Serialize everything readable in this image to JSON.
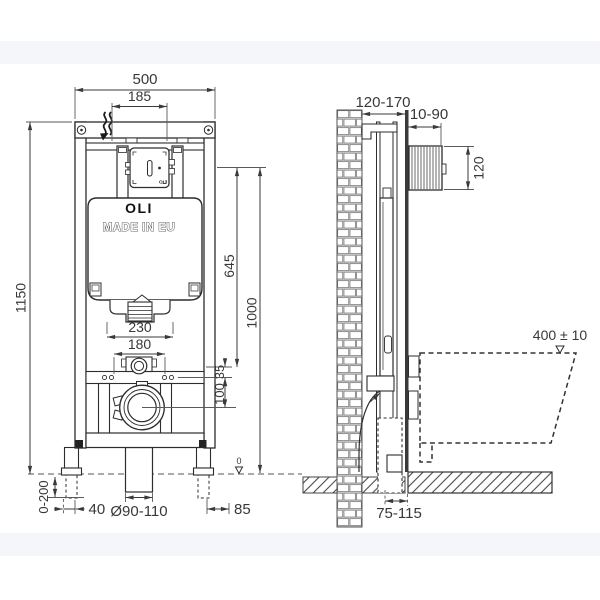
{
  "palette": {
    "line": "#2d2d2d",
    "dim_text": "#383838",
    "band": "#f4f6fa"
  },
  "front_view": {
    "dims": {
      "total_width": "500",
      "flush_plate_width": "185",
      "total_height": "1150",
      "flush_plate_height": "645",
      "reference_height": "1000",
      "bracket_width": "230",
      "fixing_spacing": "180",
      "inlet_offset": "35",
      "outlet_offset": "100",
      "foot_adjustment": "0-200",
      "foot_overhang": "40",
      "drain_diameter": "Ø90-110",
      "side_offset": "85",
      "floor_level": "0"
    },
    "labels": {
      "brand": "OLI",
      "origin": "MADE IN EU",
      "inspection_box_brand": "OLI"
    }
  },
  "side_view": {
    "dims": {
      "frame_depth_range": "120-170",
      "front_clearance": "10-90",
      "control_plate_height": "120",
      "bowl_top_height": "400 ± 10",
      "outlet_wall_offset": "75-115"
    }
  }
}
